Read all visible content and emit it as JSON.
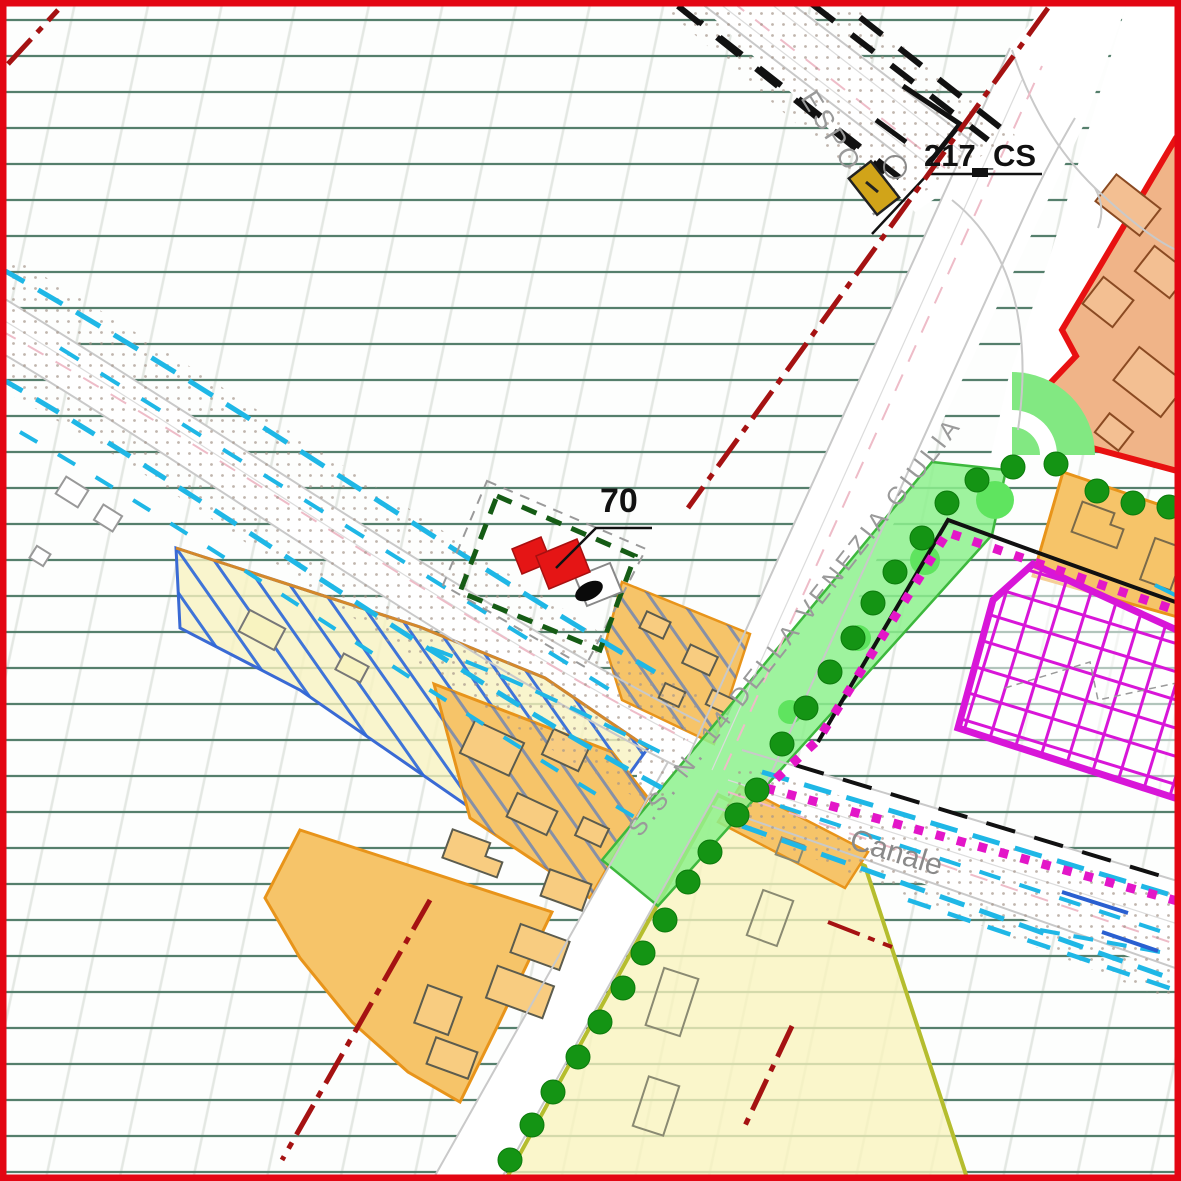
{
  "map": {
    "labels": {
      "parcel_number": "70",
      "junction_code": "217_CS",
      "top_road_name": "ESPOSTI",
      "main_road_name": "S.S. N. 14 DELLA VENEZIA GIULIA",
      "canal_label": "Canale"
    },
    "colors": {
      "map_frame": "#e30613",
      "field_line_green": "#557f6c",
      "canal_dash_cyan": "#1fb7e6",
      "residential_orange": "#f6c469",
      "expansion_pale_yellow": "#f8f3c0",
      "commercial_salmon": "#f0b488",
      "commercial_border_red": "#e81111",
      "sports_magenta": "#d816d8",
      "park_green": "#8df18d",
      "tree_green": "#149414",
      "planned_alignment_red": "#a51212",
      "site_building_red": "#e51515",
      "site_boundary_green": "#155c15",
      "blue_hatch": "#2b66d9"
    }
  }
}
